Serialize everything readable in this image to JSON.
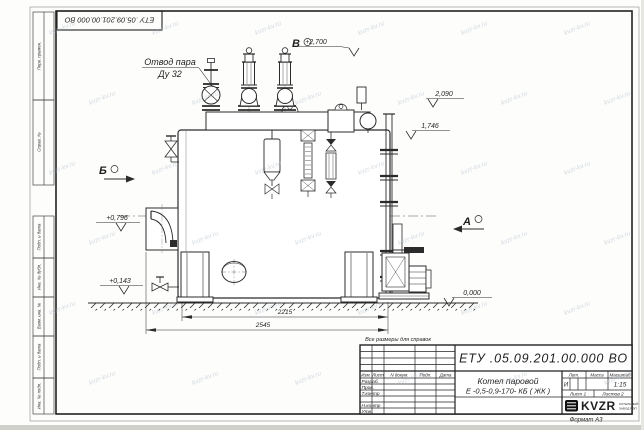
{
  "sheet": {
    "stamp_top": "ЕТУ .05.09.201.00.000  ВО",
    "format_note": "Формат А3",
    "reference_note": "Все размеры для справок",
    "watermark_text": "kvzr-kv.ru"
  },
  "margin": {
    "top": [
      "Перв. примен.",
      "Справ. №"
    ],
    "bottom": [
      "Подп. и дата",
      "Инв. № дубл.",
      "Взам. инв. №",
      "Подп. и дата",
      "Инв. № подл."
    ]
  },
  "annotations": {
    "steam_outlet_1": "Отвод пара",
    "steam_outlet_2": "Ду 32",
    "view_b": "Б",
    "view_v": "В",
    "view_a": "А",
    "elev_top": "+2,700",
    "elev_2090": "2,090",
    "elev_1746": "1,746",
    "elev_0796": "+0,796",
    "elev_0143": "+0,143",
    "elev_zero": "0,000",
    "dim_inner": "2215",
    "dim_outer": "2545"
  },
  "title_block": {
    "doc_number": "ЕТУ .05.09.201.00.000  ВО",
    "product_1": "Котел паровой",
    "product_2": "Е -0,5-0,9-170- КБ ( ЖК )",
    "col_izm": "Изм.",
    "col_list": "Лист",
    "col_doc": "N докум.",
    "col_sign": "Подп.",
    "col_date": "Дата",
    "rows": [
      "Разраб.",
      "Пров.",
      "Т.контр",
      "",
      "Н.контр",
      "Утв."
    ],
    "lit_label": "Лит.",
    "lit_value": "И",
    "mass_label": "Масса",
    "scale_label": "Масштаб",
    "scale_value": "1:15",
    "sheet_info": "Лист 1",
    "sheets_info": "Листов 2",
    "brand": "KVZR",
    "brand_sub_1": "КОТЕЛЬНЫЙ",
    "brand_sub_2": "ЗАВОД РЭП"
  }
}
